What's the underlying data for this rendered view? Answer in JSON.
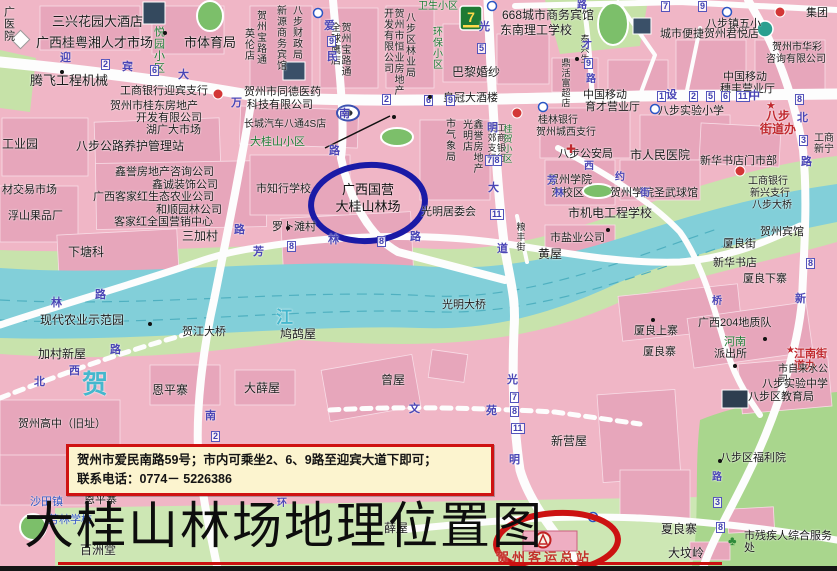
{
  "page": {
    "title_caption": "大桂山林场地理位置图"
  },
  "info_box": {
    "line1": "贺州市爱民南路59号；市内可乘坐2、6、9路至迎宾大道下即可；",
    "line2": "联系电话：0774－ 5226386"
  },
  "highlights": {
    "forest_farm": {
      "line1": "广西国营",
      "line2": "大桂山林场",
      "circle_color": "#1a1aa6"
    },
    "bus_station": {
      "label": "贺州客运总站",
      "circle_color": "#cc1212"
    }
  },
  "colors": {
    "base_pink": "#f0b6c6",
    "block_pink": "#e7a6bb",
    "river": "#82cfd9",
    "park_green": "#a9d68d",
    "band_green": "#c8e3ac",
    "road_white": "#fdfdfd"
  },
  "map": {
    "labels": [
      {
        "t": "广医院",
        "x": 2,
        "y": 6,
        "v": 1
      },
      {
        "t": "三兴花园大酒店",
        "x": 52,
        "y": 15,
        "s": 13
      },
      {
        "t": "广西桂粤湘人才市场",
        "x": 36,
        "y": 36,
        "s": 13
      },
      {
        "t": "市体育局",
        "x": 184,
        "y": 36,
        "s": 13
      },
      {
        "t": "腾飞工程机械",
        "x": 30,
        "y": 74,
        "s": 13
      },
      {
        "t": "工商银行迎宾支行",
        "x": 120,
        "y": 85
      },
      {
        "t": "贺州市桂东房地产",
        "x": 110,
        "y": 100
      },
      {
        "t": "开发有限公司",
        "x": 136,
        "y": 112
      },
      {
        "t": "湖广大市场",
        "x": 146,
        "y": 124
      },
      {
        "t": "八步公路养护管理站",
        "x": 76,
        "y": 140,
        "s": 12
      },
      {
        "t": "工业园",
        "x": 2,
        "y": 138,
        "s": 12
      },
      {
        "t": "鑫誉房地产咨询公司",
        "x": 115,
        "y": 166
      },
      {
        "t": "鑫诚装饰公司",
        "x": 152,
        "y": 179
      },
      {
        "t": "广西客家红生态农业公司",
        "x": 93,
        "y": 191
      },
      {
        "t": "和顺园林公司",
        "x": 156,
        "y": 204
      },
      {
        "t": "客家红全国营销中心",
        "x": 114,
        "y": 216
      },
      {
        "t": "材交易市场",
        "x": 2,
        "y": 184
      },
      {
        "t": "浮山果品厂",
        "x": 8,
        "y": 210
      },
      {
        "t": "下塘科",
        "x": 68,
        "y": 246,
        "s": 12
      },
      {
        "t": "三加村",
        "x": 182,
        "y": 230,
        "s": 12
      },
      {
        "t": "现代农业示范园",
        "x": 40,
        "y": 314,
        "s": 12
      },
      {
        "t": "加村新屋",
        "x": 38,
        "y": 348,
        "s": 12
      },
      {
        "t": "贺江大桥",
        "x": 182,
        "y": 326
      },
      {
        "t": "贺",
        "x": 82,
        "y": 370,
        "c": "cyan",
        "s": 26
      },
      {
        "t": "江",
        "x": 276,
        "y": 308,
        "c": "cyan",
        "s": 17
      },
      {
        "t": "恩平寨",
        "x": 152,
        "y": 384,
        "s": 12
      },
      {
        "t": "大薛屋",
        "x": 244,
        "y": 382,
        "s": 12
      },
      {
        "t": "贺州高中（旧址）",
        "x": 18,
        "y": 418
      },
      {
        "t": "恩平寨",
        "x": 84,
        "y": 494
      },
      {
        "t": "沙田镇",
        "x": 30,
        "y": 496,
        "c": "blu"
      },
      {
        "t": "芳林学校",
        "x": 48,
        "y": 514,
        "c": "blu"
      },
      {
        "t": "百洲堂",
        "x": 80,
        "y": 544,
        "s": 12
      },
      {
        "t": "薛屋",
        "x": 384,
        "y": 522,
        "s": 12
      },
      {
        "t": "悦园小区",
        "x": 152,
        "y": 26,
        "v": 1,
        "c": "grn"
      },
      {
        "t": "贺州宝路通",
        "x": 254,
        "y": 10,
        "v": 1,
        "s": 10
      },
      {
        "t": "英伦店",
        "x": 242,
        "y": 28,
        "v": 1,
        "s": 10
      },
      {
        "t": "新源商务宾馆",
        "x": 274,
        "y": 5,
        "v": 1,
        "s": 10
      },
      {
        "t": "八步财政局",
        "x": 290,
        "y": 5,
        "v": 1,
        "s": 10
      },
      {
        "t": "贺州宝路通\n全球鹰店",
        "x": 328,
        "y": 22,
        "v": 1,
        "s": 10
      },
      {
        "t": "贺州市恒业房地产\n开发有限公司",
        "x": 381,
        "y": 8,
        "v": 1,
        "s": 10
      },
      {
        "t": "八步区林业局",
        "x": 403,
        "y": 12,
        "v": 1,
        "s": 10
      },
      {
        "t": "卫生小区",
        "x": 418,
        "y": 1,
        "c": "grn",
        "s": 10
      },
      {
        "t": "环保小区",
        "x": 430,
        "y": 26,
        "v": 1,
        "c": "grn",
        "s": 10
      },
      {
        "t": "668城市商务宾馆",
        "x": 502,
        "y": 9,
        "s": 12
      },
      {
        "t": "东南理工学校",
        "x": 500,
        "y": 24,
        "s": 12
      },
      {
        "t": "巴黎婚纱",
        "x": 452,
        "y": 66,
        "s": 12
      },
      {
        "t": "皇冠大酒楼",
        "x": 443,
        "y": 92
      },
      {
        "t": "贺州市同德医药",
        "x": 244,
        "y": 86
      },
      {
        "t": "科技有限公司",
        "x": 247,
        "y": 99
      },
      {
        "t": "长城汽车八通4S店",
        "x": 244,
        "y": 119,
        "s": 10
      },
      {
        "t": "大桂山小区",
        "x": 250,
        "y": 136,
        "c": "grn"
      },
      {
        "t": "市知行学校",
        "x": 256,
        "y": 183
      },
      {
        "t": "罗卜滩村",
        "x": 272,
        "y": 221
      },
      {
        "t": "市气象局",
        "x": 443,
        "y": 118,
        "v": 1,
        "s": 10
      },
      {
        "t": "鑫誉房地产\n光明店",
        "x": 460,
        "y": 119,
        "v": 1,
        "s": 10
      },
      {
        "t": "光明居委会",
        "x": 421,
        "y": 206
      },
      {
        "t": "黄屋",
        "x": 538,
        "y": 248,
        "s": 12
      },
      {
        "t": "市盐业公司",
        "x": 550,
        "y": 232
      },
      {
        "t": "市机电工程学校",
        "x": 568,
        "y": 207,
        "s": 12
      },
      {
        "t": "贺州学院圣武球馆",
        "x": 610,
        "y": 187
      },
      {
        "t": "贺州学院",
        "x": 548,
        "y": 174
      },
      {
        "t": "东校区",
        "x": 551,
        "y": 187
      },
      {
        "t": "八步公安局",
        "x": 558,
        "y": 148
      },
      {
        "t": "市人民医院",
        "x": 630,
        "y": 149,
        "s": 12
      },
      {
        "t": "新华书店门市部",
        "x": 700,
        "y": 155
      },
      {
        "t": "桂林银行",
        "x": 538,
        "y": 115,
        "s": 10
      },
      {
        "t": "贺州城西支行",
        "x": 536,
        "y": 127,
        "s": 10
      },
      {
        "t": "工商银行\n西郊支行",
        "x": 486,
        "y": 123,
        "v": 1,
        "s": 9
      },
      {
        "t": "桂贺小区",
        "x": 502,
        "y": 124,
        "v": 1,
        "c": "grn",
        "s": 9
      },
      {
        "t": "八步实验小学",
        "x": 658,
        "y": 105
      },
      {
        "t": "八步\n街道办",
        "x": 760,
        "y": 110,
        "c": "red",
        "s": 12,
        "b": 1,
        "ctr": 1
      },
      {
        "t": "中国移动",
        "x": 723,
        "y": 71
      },
      {
        "t": "穗丰营业厅",
        "x": 720,
        "y": 83
      },
      {
        "t": "中国移动",
        "x": 583,
        "y": 89
      },
      {
        "t": "育才营业厅",
        "x": 585,
        "y": 101
      },
      {
        "t": "城市便捷贺州君悦店",
        "x": 660,
        "y": 28
      },
      {
        "t": "八步镇五小",
        "x": 706,
        "y": 18
      },
      {
        "t": "贺州市华彩",
        "x": 772,
        "y": 42,
        "s": 10
      },
      {
        "t": "咨询有限公司",
        "x": 766,
        "y": 54,
        "s": 10
      },
      {
        "t": "集团",
        "x": 806,
        "y": 7
      },
      {
        "t": "泰兴生",
        "x": 579,
        "y": 34,
        "v": 1,
        "s": 9
      },
      {
        "t": "鼎活富超店",
        "x": 560,
        "y": 58,
        "v": 1,
        "s": 9
      },
      {
        "t": "工商\n新宁",
        "x": 814,
        "y": 133,
        "s": 10
      },
      {
        "t": "贺州宾馆",
        "x": 760,
        "y": 226
      },
      {
        "t": "厦良街",
        "x": 723,
        "y": 238
      },
      {
        "t": "新华书店",
        "x": 713,
        "y": 257
      },
      {
        "t": "厦良下寨",
        "x": 743,
        "y": 273
      },
      {
        "t": "工商银行",
        "x": 748,
        "y": 176,
        "s": 10
      },
      {
        "t": "新兴支行",
        "x": 750,
        "y": 188,
        "s": 10
      },
      {
        "t": "八步大桥",
        "x": 752,
        "y": 200,
        "s": 10
      },
      {
        "t": "广西204地质队",
        "x": 698,
        "y": 317
      },
      {
        "t": "河南",
        "x": 724,
        "y": 336,
        "c": "grn"
      },
      {
        "t": "派出所",
        "x": 714,
        "y": 348
      },
      {
        "t": "厦良上寨",
        "x": 634,
        "y": 325
      },
      {
        "t": "厦良寨",
        "x": 643,
        "y": 346
      },
      {
        "t": "江南街道办",
        "x": 794,
        "y": 348,
        "c": "red",
        "b": 1
      },
      {
        "t": "市自来水公司",
        "x": 778,
        "y": 364,
        "s": 10
      },
      {
        "t": "八步实验中学",
        "x": 762,
        "y": 378
      },
      {
        "t": "八步区教育局",
        "x": 748,
        "y": 391
      },
      {
        "t": "八步区福利院",
        "x": 720,
        "y": 452
      },
      {
        "t": "市残疾人综合服务处",
        "x": 744,
        "y": 530
      },
      {
        "t": "夏良寨",
        "x": 661,
        "y": 523,
        "s": 12
      },
      {
        "t": "大坟岭",
        "x": 668,
        "y": 547,
        "s": 12
      },
      {
        "t": "新营屋",
        "x": 551,
        "y": 435,
        "s": 12
      },
      {
        "t": "曾屋",
        "x": 381,
        "y": 374,
        "s": 12
      },
      {
        "t": "鸠鸪屋",
        "x": 280,
        "y": 328,
        "s": 12
      },
      {
        "t": "光明大桥",
        "x": 442,
        "y": 299
      },
      {
        "t": "粮丰街",
        "x": 515,
        "y": 222,
        "v": 1,
        "s": 9
      },
      {
        "t": "★",
        "x": 766,
        "y": 100,
        "c": "red",
        "s": 11
      },
      {
        "t": "★",
        "x": 786,
        "y": 345,
        "c": "red",
        "s": 10
      },
      {
        "t": "✚",
        "x": 566,
        "y": 143,
        "c": "red",
        "s": 12
      },
      {
        "t": "迎",
        "x": 60,
        "y": 52,
        "c": "road"
      },
      {
        "t": "宾",
        "x": 122,
        "y": 61,
        "c": "road"
      },
      {
        "t": "大",
        "x": 178,
        "y": 69,
        "c": "road"
      },
      {
        "t": "万",
        "x": 231,
        "y": 97,
        "c": "road"
      },
      {
        "t": "设",
        "x": 666,
        "y": 89,
        "c": "road"
      },
      {
        "t": "中",
        "x": 749,
        "y": 90,
        "c": "road"
      },
      {
        "t": "爱",
        "x": 324,
        "y": 20,
        "c": "road"
      },
      {
        "t": "民",
        "x": 327,
        "y": 51,
        "c": "road"
      },
      {
        "t": "南",
        "x": 339,
        "y": 108,
        "c": "road"
      },
      {
        "t": "路",
        "x": 329,
        "y": 145,
        "c": "road"
      },
      {
        "t": "光",
        "x": 479,
        "y": 21,
        "c": "road"
      },
      {
        "t": "明",
        "x": 487,
        "y": 122,
        "c": "road"
      },
      {
        "t": "大",
        "x": 488,
        "y": 182,
        "c": "road"
      },
      {
        "t": "道",
        "x": 497,
        "y": 243,
        "c": "road"
      },
      {
        "t": "光",
        "x": 507,
        "y": 374,
        "c": "road"
      },
      {
        "t": "明",
        "x": 509,
        "y": 454,
        "c": "road"
      },
      {
        "t": "北",
        "x": 797,
        "y": 112,
        "c": "road"
      },
      {
        "t": "路",
        "x": 801,
        "y": 156,
        "c": "road"
      },
      {
        "t": "新",
        "x": 795,
        "y": 293,
        "c": "road"
      },
      {
        "t": "西",
        "x": 584,
        "y": 161,
        "c": "road",
        "s": 10
      },
      {
        "t": "约",
        "x": 615,
        "y": 172,
        "c": "road",
        "s": 10
      },
      {
        "t": "街",
        "x": 640,
        "y": 188,
        "c": "road",
        "s": 10
      },
      {
        "t": "林",
        "x": 328,
        "y": 234,
        "c": "road"
      },
      {
        "t": "路",
        "x": 410,
        "y": 231,
        "c": "road"
      },
      {
        "t": "芳",
        "x": 547,
        "y": 176,
        "c": "road",
        "s": 10
      },
      {
        "t": "林",
        "x": 554,
        "y": 188,
        "c": "road",
        "s": 10
      },
      {
        "t": "路",
        "x": 234,
        "y": 224,
        "c": "road"
      },
      {
        "t": "芳",
        "x": 253,
        "y": 246,
        "c": "road"
      },
      {
        "t": "路",
        "x": 95,
        "y": 289,
        "c": "road"
      },
      {
        "t": "林",
        "x": 51,
        "y": 297,
        "c": "road"
      },
      {
        "t": "北",
        "x": 34,
        "y": 376,
        "c": "road"
      },
      {
        "t": "西",
        "x": 69,
        "y": 365,
        "c": "road"
      },
      {
        "t": "路",
        "x": 110,
        "y": 344,
        "c": "road"
      },
      {
        "t": "南",
        "x": 205,
        "y": 410,
        "c": "road"
      },
      {
        "t": "文",
        "x": 409,
        "y": 403,
        "c": "road"
      },
      {
        "t": "苑",
        "x": 486,
        "y": 405,
        "c": "road"
      },
      {
        "t": "环",
        "x": 277,
        "y": 498,
        "c": "road",
        "s": 10
      },
      {
        "t": "桥",
        "x": 712,
        "y": 296,
        "c": "road",
        "s": 10
      },
      {
        "t": "才",
        "x": 582,
        "y": 40,
        "c": "road",
        "s": 10
      },
      {
        "t": "路",
        "x": 586,
        "y": 74,
        "c": "road",
        "s": 10
      },
      {
        "t": "路",
        "x": 577,
        "y": 0,
        "c": "road",
        "s": 10
      },
      {
        "t": "路",
        "x": 712,
        "y": 472,
        "c": "road",
        "s": 10
      },
      {
        "t": "2",
        "x": 101,
        "y": 59,
        "c": "badge"
      },
      {
        "t": "6",
        "x": 150,
        "y": 65,
        "c": "badge"
      },
      {
        "t": "2",
        "x": 382,
        "y": 94,
        "c": "badge"
      },
      {
        "t": "6",
        "x": 424,
        "y": 95,
        "c": "badge"
      },
      {
        "t": "9",
        "x": 446,
        "y": 95,
        "c": "badge"
      },
      {
        "t": "1",
        "x": 657,
        "y": 91,
        "c": "badge"
      },
      {
        "t": "2",
        "x": 689,
        "y": 91,
        "c": "badge"
      },
      {
        "t": "5",
        "x": 706,
        "y": 91,
        "c": "badge"
      },
      {
        "t": "6",
        "x": 721,
        "y": 91,
        "c": "badge"
      },
      {
        "t": "11",
        "x": 736,
        "y": 91,
        "c": "badge"
      },
      {
        "t": "8",
        "x": 795,
        "y": 94,
        "c": "badge"
      },
      {
        "t": "9",
        "x": 327,
        "y": 36,
        "c": "badge"
      },
      {
        "t": "5",
        "x": 477,
        "y": 43,
        "c": "badge"
      },
      {
        "t": "7|8",
        "x": 485,
        "y": 155,
        "c": "badge"
      },
      {
        "t": "11",
        "x": 490,
        "y": 209,
        "c": "badge"
      },
      {
        "t": "7",
        "x": 510,
        "y": 392,
        "c": "badge"
      },
      {
        "t": "8",
        "x": 510,
        "y": 406,
        "c": "badge"
      },
      {
        "t": "11",
        "x": 511,
        "y": 423,
        "c": "badge"
      },
      {
        "t": "3",
        "x": 799,
        "y": 135,
        "c": "badge"
      },
      {
        "t": "8",
        "x": 806,
        "y": 258,
        "c": "badge"
      },
      {
        "t": "8",
        "x": 287,
        "y": 241,
        "c": "badge"
      },
      {
        "t": "8",
        "x": 377,
        "y": 236,
        "c": "badge"
      },
      {
        "t": "2",
        "x": 211,
        "y": 431,
        "c": "badge"
      },
      {
        "t": "3",
        "x": 713,
        "y": 497,
        "c": "badge"
      },
      {
        "t": "8",
        "x": 716,
        "y": 522,
        "c": "badge"
      },
      {
        "t": "7",
        "x": 661,
        "y": 1,
        "c": "badge"
      },
      {
        "t": "9",
        "x": 698,
        "y": 1,
        "c": "badge"
      },
      {
        "t": "9",
        "x": 584,
        "y": 58,
        "c": "badge"
      }
    ],
    "dots": [
      [
        392,
        115
      ],
      [
        163,
        31
      ],
      [
        60,
        70
      ],
      [
        148,
        322
      ],
      [
        763,
        337
      ],
      [
        733,
        364
      ],
      [
        718,
        459
      ],
      [
        575,
        57
      ],
      [
        428,
        95
      ],
      [
        606,
        228
      ],
      [
        286,
        226
      ],
      [
        651,
        318
      ]
    ]
  }
}
